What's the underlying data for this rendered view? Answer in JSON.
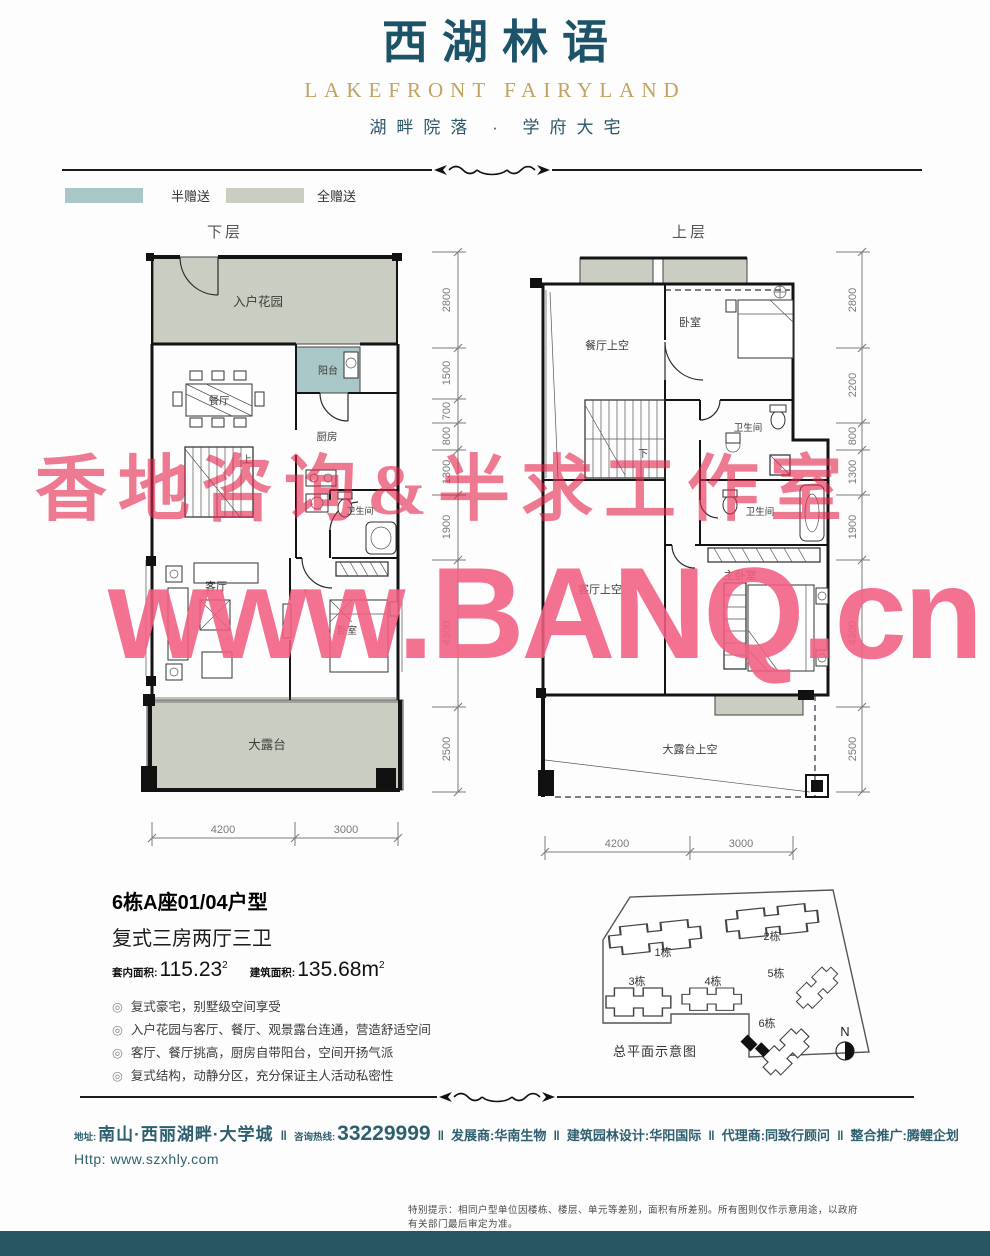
{
  "header": {
    "logo_cn": "西湖林语",
    "logo_en": "LAKEFRONT FAIRYLAND",
    "tagline": "湖畔院落 · 学府大宅"
  },
  "legend": {
    "half_label": "半赠送",
    "full_label": "全赠送"
  },
  "plan_lower": {
    "title": "下层",
    "rooms": {
      "garden": "入户花园",
      "balcony": "阳台",
      "dining": "餐厅",
      "kitchen": "厨房",
      "bath": "卫生间",
      "stairs": "上",
      "living": "客厅",
      "bedroom": "卧室",
      "terrace": "大露台"
    },
    "dims_right": [
      "2800",
      "1500",
      "700",
      "800",
      "1300",
      "1900",
      "4300",
      "2500"
    ],
    "dims_bottom": [
      "4200",
      "3000"
    ]
  },
  "plan_upper": {
    "title": "上层",
    "rooms": {
      "dining_void": "餐厅上空",
      "bedroom": "卧室",
      "bath1": "卫生间",
      "bath2": "卫生间",
      "stairs": "下",
      "master": "主卧室",
      "living_void": "客厅上空",
      "terrace_void": "大露台上空"
    },
    "dims_right": [
      "2800",
      "2200",
      "800",
      "1300",
      "1900",
      "4300",
      "2500"
    ],
    "dims_bottom": [
      "4200",
      "3000"
    ]
  },
  "unit": {
    "name": "6栋A座01/04户型",
    "layout": "复式三房两厅三卫",
    "bullet": "◎",
    "area_inner_label": "套内面积:",
    "area_inner_value": "115.23",
    "area_inner_sup": "2",
    "area_build_label": "建筑面积:",
    "area_build_value": "135.68m",
    "area_build_sup": "2",
    "features": [
      "复式豪宅，别墅级空间享受",
      "入户花园与客厅、餐厅、观景露台连通，营造舒适空间",
      "客厅、餐厅挑高，厨房自带阳台，空间开扬气派",
      "复式结构，动静分区，充分保证主人活动私密性"
    ]
  },
  "siteplan": {
    "caption": "总平面示意图",
    "north": "N",
    "buildings": [
      "1栋",
      "2栋",
      "3栋",
      "4栋",
      "5栋",
      "6栋"
    ]
  },
  "footer": {
    "sep": "‖",
    "addr_label": "地址:",
    "addr": "南山·西丽湖畔·大学城",
    "hotline_label": "咨询热线:",
    "hotline": "33229999",
    "dev_label": "发展商:",
    "dev": "华南生物",
    "design_label": "建筑园林设计:",
    "design": "华阳国际",
    "agent_label": "代理商:",
    "agent": "同致行顾问",
    "promo_label": "整合推广:",
    "promo": "腾鲤企划",
    "url": "Http: www.szxhly.com"
  },
  "disclaimer": "特别提示：相同户型单位因楼栋、楼层、单元等差别，面积有所差别。所有图则仅作示意用途，以政府有关部门最后审定为准。",
  "watermarks": {
    "wm1": "香地咨询&半求工作室",
    "wm2": "www.BANQ.cn"
  },
  "colors": {
    "brand_teal": "#1d5368",
    "gold": "#c2a35f",
    "half_gift": "#a9c7c6",
    "full_gift": "#c9cdc2",
    "footer_text": "#2e5f6e",
    "bottom_bar": "#295663",
    "wm_red": "#e2234a",
    "wm_pink": "#f15f82"
  }
}
